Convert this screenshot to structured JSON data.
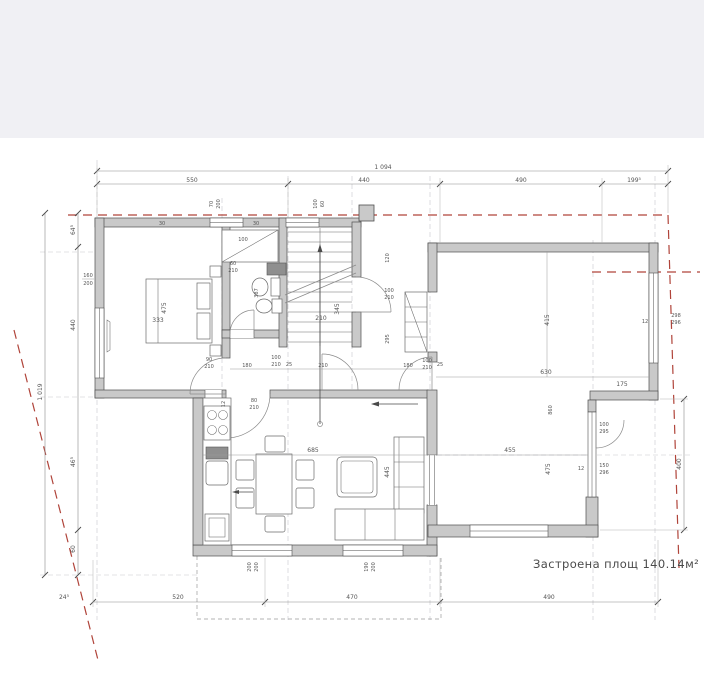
{
  "colors": {
    "top_band": "#f0f0f4",
    "paper": "#ffffff",
    "wall_fill": "#c9c9c9",
    "wall_stroke": "#4f4f4f",
    "boundary_red": "#b0443a",
    "dim_text": "#555555"
  },
  "area_note": "Застроена площ 140.14м²",
  "labels": {
    "t_total": "1 094",
    "t1": "550",
    "t2": "440",
    "t3": "490",
    "t4": "199⁵",
    "l_total": "1 019",
    "l1": "64⁵",
    "l2": "440",
    "l3": "46⁵",
    "l4": "60",
    "b0": "24⁵",
    "b1": "520",
    "b2": "470",
    "b3": "490",
    "r1": "400",
    "wall30a": "30",
    "wall30b": "30",
    "tw70": "70",
    "tw200": "200",
    "sw100": "100",
    "sw60": "60",
    "bd475": "475",
    "bd333": "333",
    "bdwin160": "160",
    "bdwin200": "200",
    "ba100": "100",
    "ba387": "387",
    "ba60": "60",
    "ba210": "210",
    "st210": "210",
    "st345": "345",
    "st120": "120",
    "st100": "100",
    "st210b": "210",
    "st295": "295",
    "c90": "90",
    "c210a": "210",
    "c180a": "180",
    "c100a": "100",
    "c210b": "210",
    "c25a": "25",
    "c210c": "210",
    "c180b": "180",
    "c100b": "100",
    "c210d": "210",
    "c25b": "25",
    "c12": "12",
    "c80": "80",
    "c210e": "210",
    "rr415": "415",
    "rr630": "630",
    "rr860": "860",
    "rr455": "455",
    "rr475": "475",
    "rr175": "175",
    "rr12a": "12",
    "rr298": "298",
    "rr296": "296",
    "rr100": "100",
    "rr295": "295",
    "rr12b": "12",
    "rr150": "150",
    "rr296b": "296",
    "lv685": "685",
    "lv445": "445",
    "lv200a": "200",
    "lv200b": "200",
    "lv190": "190",
    "lv200c": "200"
  }
}
